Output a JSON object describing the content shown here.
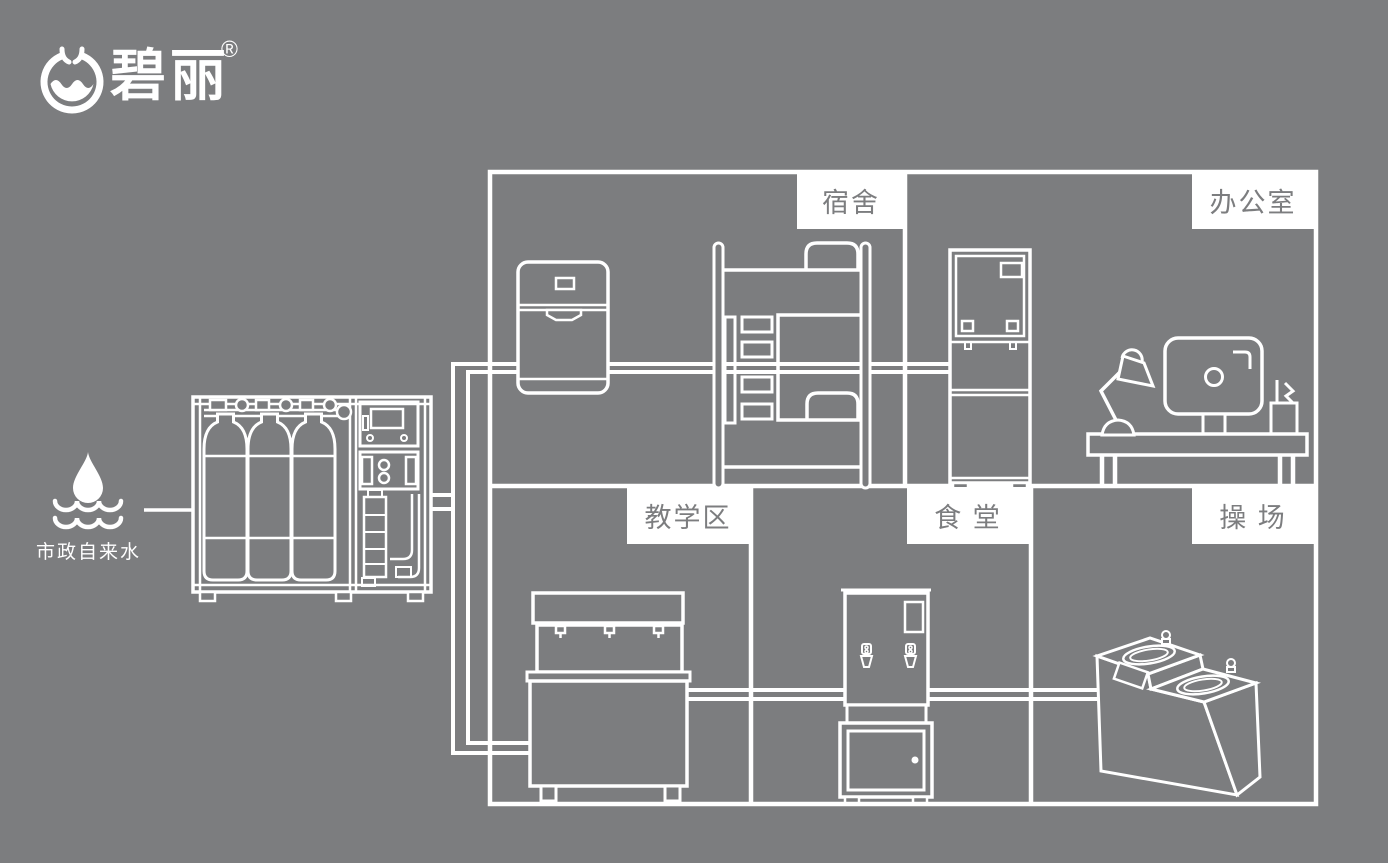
{
  "colors": {
    "background": "#7c7d7f",
    "line": "#ffffff",
    "label_box_bg": "#ffffff",
    "label_text": "#7c7d7f"
  },
  "logo": {
    "brand_text": "碧丽",
    "registered_mark": "®",
    "icon": "bili-water-bowl-icon"
  },
  "water_source": {
    "label": "市政自来水",
    "icon": "water-drop-and-waves-icon"
  },
  "machine": {
    "icon": "water-purification-system-icon"
  },
  "zones": [
    {
      "id": "dormitory",
      "label": "宿舍",
      "equipment": [
        "water-dispenser-icon",
        "bunk-bed-icon"
      ]
    },
    {
      "id": "office",
      "label": "办公室",
      "equipment": [
        "vertical-water-dispenser-icon",
        "office-desk-icon"
      ]
    },
    {
      "id": "teaching-area",
      "label": "教学区",
      "equipment": [
        "drinking-water-station-icon"
      ]
    },
    {
      "id": "canteen",
      "label": "食 堂",
      "equipment": [
        "water-boiler-icon"
      ]
    },
    {
      "id": "playground",
      "label": "操 场",
      "equipment": [
        "outdoor-drinking-fountain-icon"
      ]
    }
  ]
}
